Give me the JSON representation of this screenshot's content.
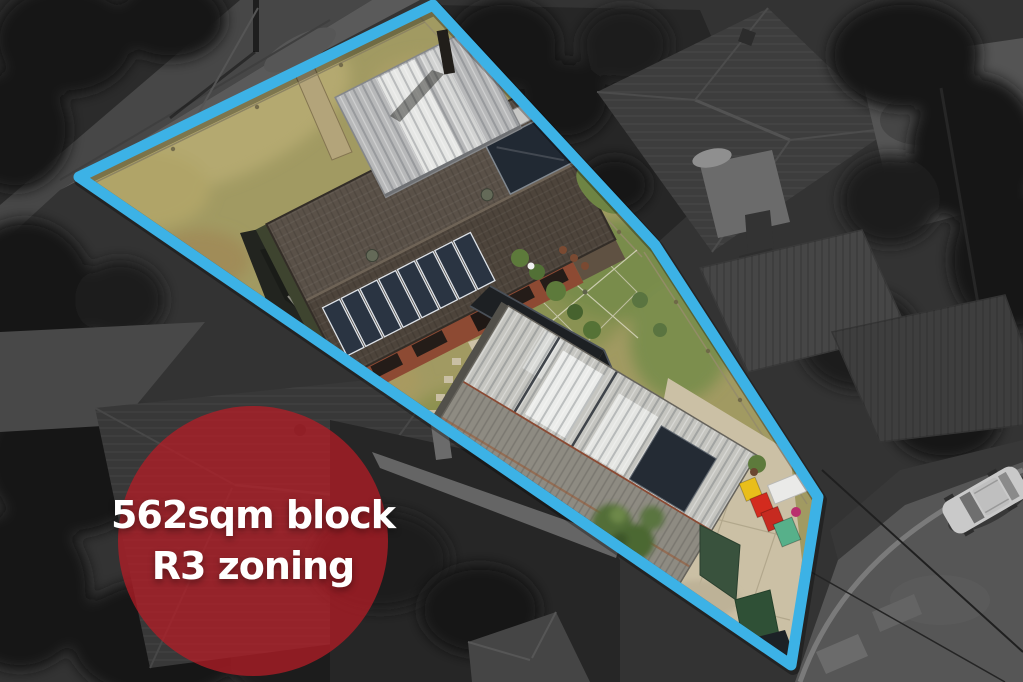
{
  "badge": {
    "line1": "562sqm block",
    "line2": "R3 zoning"
  },
  "boundary": {
    "points": "433,5 655,245 818,497 791,665 79,177"
  },
  "theme": {
    "boundary_color": "#3cb2e6",
    "badge_fill": "rgba(182,28,38,0.74)",
    "badge_text_color": "#ffffff"
  },
  "scene": {
    "bin_colors": {
      "bin1": "#e9be1b",
      "bin2": "#d32b1e",
      "bin3": "#c62a20",
      "bin4": "#57b08a"
    }
  }
}
